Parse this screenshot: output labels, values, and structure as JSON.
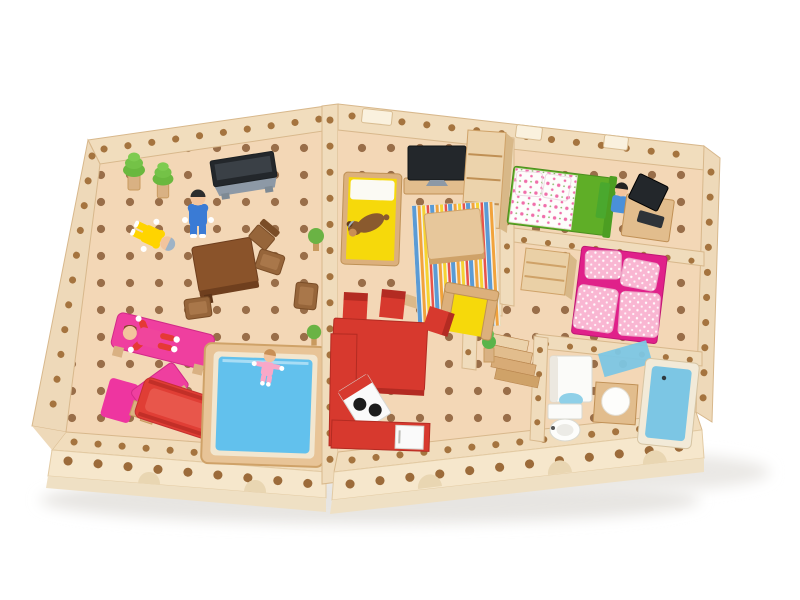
{
  "scene": {
    "type": "photograph",
    "subject": "Overhead photo of a wooden toy dollhouse built from peg-and-hole building blocks: an open courtyard with peg dolls, sun loungers, red slide and blue pool on the left, and a five-room house (living room, red kitchen, two bedrooms, bathroom) on the right, all on a white background",
    "background_color": "#ffffff"
  },
  "colors": {
    "wood_light": "#f1ddbd",
    "wood_mid": "#e2bd8d",
    "wood_floor": "#f3d7b6",
    "wood_dark": "#c09055",
    "hole_floor": "#8a5c36",
    "hole_wall": "#a5743f",
    "tv_screen": "#23272b",
    "tv_stand": "#8d99a6",
    "tree_green": "#6ab83e",
    "skin": "#f3c49d",
    "man_shirt": "#3a7bd5",
    "grandma_outfit": "#ffd400",
    "woman_dress": "#f0459c",
    "woman_limbs": "#e53935",
    "baby_outfit": "#f8a8c8",
    "boy_shirt": "#4a90d9",
    "dog_brown": "#8a5a2e",
    "lounger_pink": "#ef3f9f",
    "slide_red": "#e03e35",
    "pool_water": "#62c1ed",
    "sofa_yellow": "#f6d90b",
    "rug_blue": "#5b9bd5",
    "rug_orange": "#f2a33c",
    "rug_red": "#e8534a",
    "rug_yellow": "#f6d332",
    "dining_red": "#d7392e",
    "stove_white": "#fafafa",
    "burner_black": "#1c1c1c",
    "bed_green": "#5fae27",
    "floral_white": "#fdfdfb",
    "floral_pink": "#f06eaa",
    "bed_pink_base": "#e0218a",
    "bed_pink_soft": "#f9b6d2",
    "chair_green": "#4aa82e",
    "bath_blue": "#7cc6e4",
    "fixture_white": "#fbfbf9"
  },
  "objects": [
    {
      "name": "courtyard",
      "label": "Open courtyard with peg-hole floor and block walls"
    },
    {
      "name": "trees",
      "label": "Two green trees in wooden pots"
    },
    {
      "name": "outdoor-tv",
      "label": "Flat TV on grey stand against the courtyard wall"
    },
    {
      "name": "father-doll",
      "label": "Peg doll in blue outfit standing by the table"
    },
    {
      "name": "grandma-doll",
      "label": "Grey-haired peg doll in yellow outfit lying on the floor"
    },
    {
      "name": "wooden-table",
      "label": "Dark brown wooden table with scattered stools"
    },
    {
      "name": "mother-doll",
      "label": "Peg doll in pink lying on a magenta sun lounger"
    },
    {
      "name": "sun-lounger",
      "label": "Second magenta recliner lounger"
    },
    {
      "name": "slide",
      "label": "Red toy slide on wooden supports"
    },
    {
      "name": "pool",
      "label": "Swimming pool with wooden rim and blue water"
    },
    {
      "name": "baby-doll",
      "label": "Baby peg doll in pink standing in the pool"
    },
    {
      "name": "living-room",
      "label": "Living room: TV, yellow day-bed with toy dog, shelf, striped rug, coffee table, yellow armchair"
    },
    {
      "name": "dining-kitchen",
      "label": "Red dining table, red chairs and red kitchen counters with white stove (two black burners) and white door"
    },
    {
      "name": "hallway",
      "label": "Hallway with wooden staircase and green potted plants"
    },
    {
      "name": "bedroom-floral",
      "label": "Bedroom with green bed, white floral bedding and pillows"
    },
    {
      "name": "study-corner",
      "label": "Desk with dark computer monitor, green chair and boy doll in blue"
    },
    {
      "name": "bedroom-pink",
      "label": "Bedroom with magenta bed, pink polka-dot pillows and duvet, wooden dresser"
    },
    {
      "name": "bathroom",
      "label": "Bathroom with white shower cabinet, round washbasin on wooden stand, toilet, blue bath mat and blue bathtub"
    }
  ]
}
